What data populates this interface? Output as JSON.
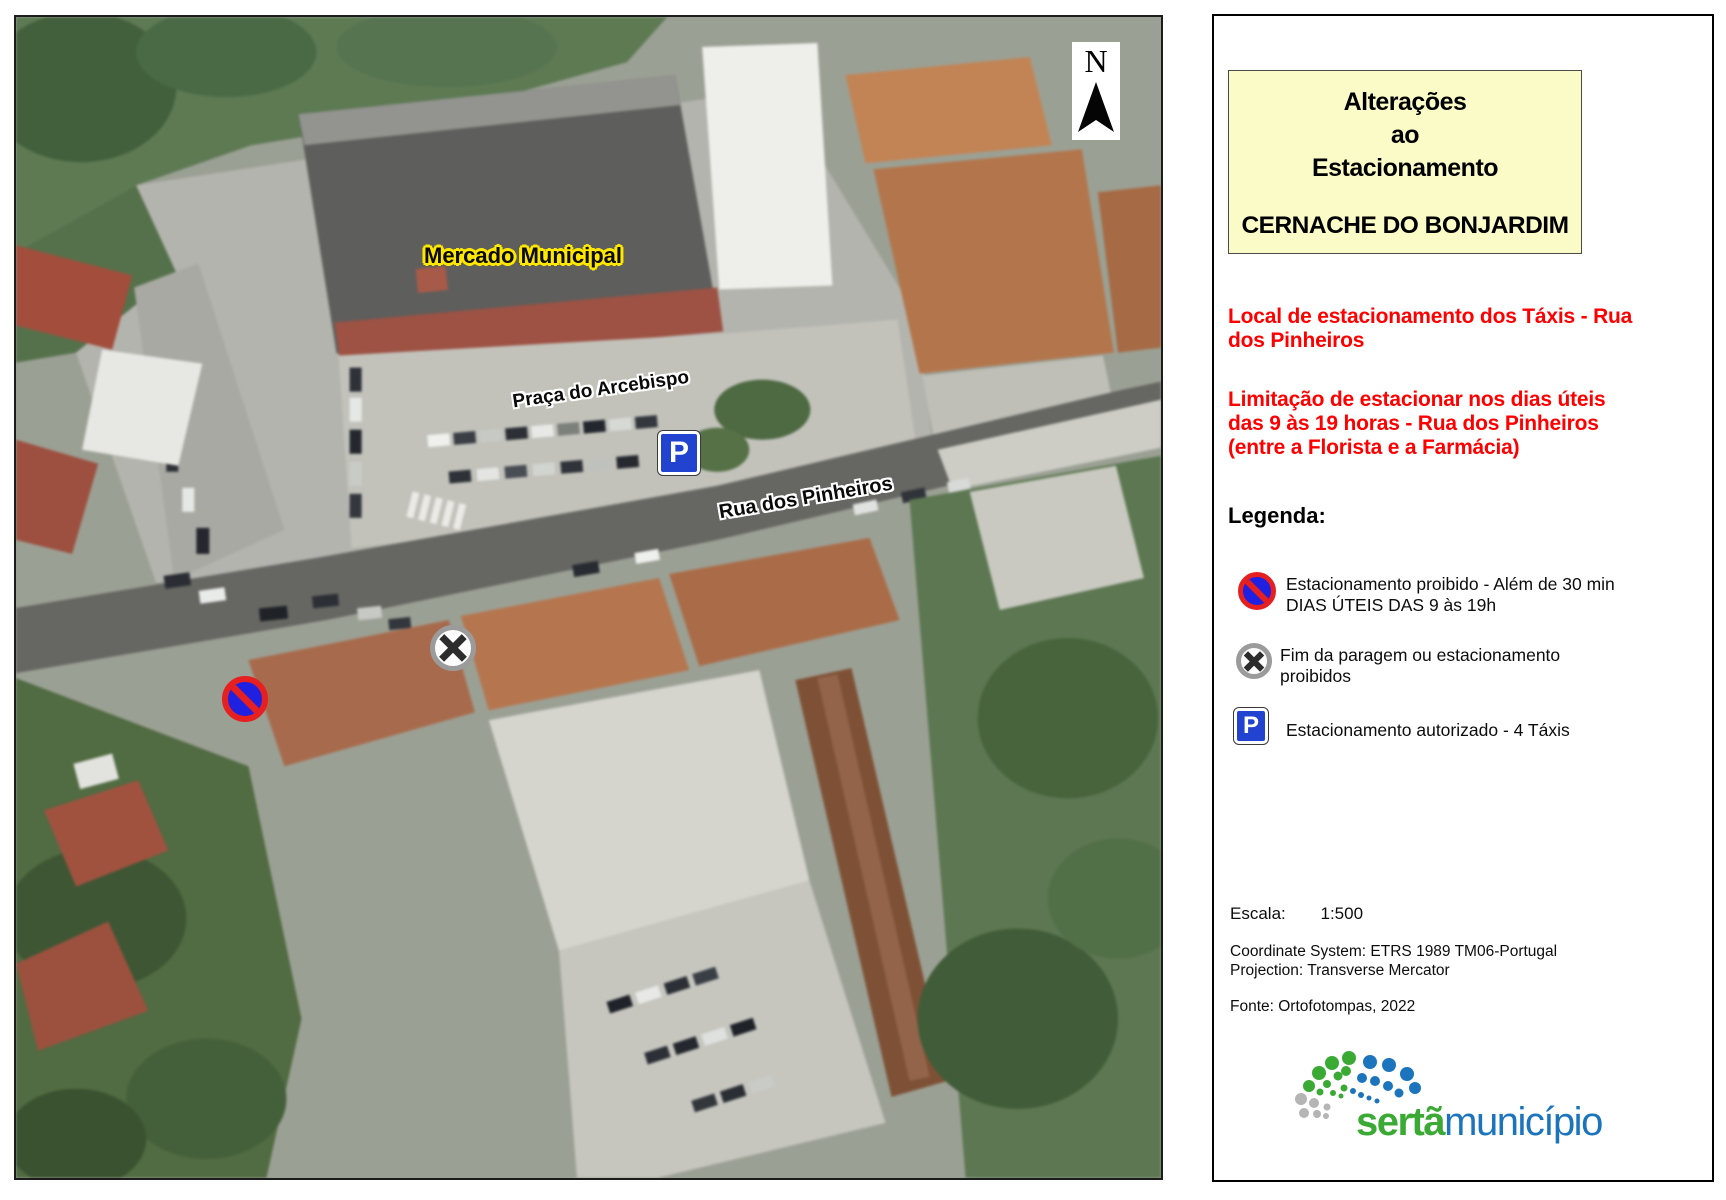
{
  "map": {
    "labels": {
      "mercado": "Mercado Municipal",
      "praca": "Praça do Arcebispo",
      "rua": "Rua dos Pinheiros"
    },
    "north": {
      "letter": "N"
    },
    "signs": {
      "parking_letter": "P"
    }
  },
  "panel": {
    "title": {
      "text": "Alterações\nao\nEstacionamento",
      "subtitle": "CERNACHE DO BONJARDIM"
    },
    "notes": [
      "Local de estacionamento dos Táxis - Rua\ndos Pinheiros",
      "Limitação de estacionar nos dias úteis\ndas 9 às 19 horas - Rua dos Pinheiros\n(entre a Florista e a Farmácia)"
    ],
    "legend": {
      "heading": "Legenda:",
      "parking_letter": "P",
      "items": [
        {
          "icon": "no-parking-icon",
          "text": "Estacionamento proibido - Além de 30 min\nDIAS ÚTEIS DAS 9 às 19h"
        },
        {
          "icon": "end-restriction-icon",
          "text": "Fim da paragem ou estacionamento\nproibidos"
        },
        {
          "icon": "parking-icon",
          "text": "Estacionamento autorizado - 4 Táxis"
        }
      ]
    },
    "scale": {
      "label": "Escala:",
      "value": "1:500"
    },
    "meta": {
      "coordinate_system": "Coordinate System: ETRS 1989 TM06-Portugal",
      "projection": "Projection: Transverse Mercator",
      "source": "Fonte: Ortofotompas, 2022"
    },
    "logo": {
      "name_bold": "sertã",
      "name_regular": "município"
    }
  },
  "colors": {
    "title_box_bg": "#fbfbc8",
    "note_red": "#ff0000",
    "sign_blue": "#2143cf",
    "prohibition_ring_red": "#e62020",
    "prohibition_fill_blue": "#2020e0",
    "end_sign_gray": "#9b9b9b",
    "logo_green": "#3aaa35",
    "logo_blue": "#1c75bc"
  }
}
